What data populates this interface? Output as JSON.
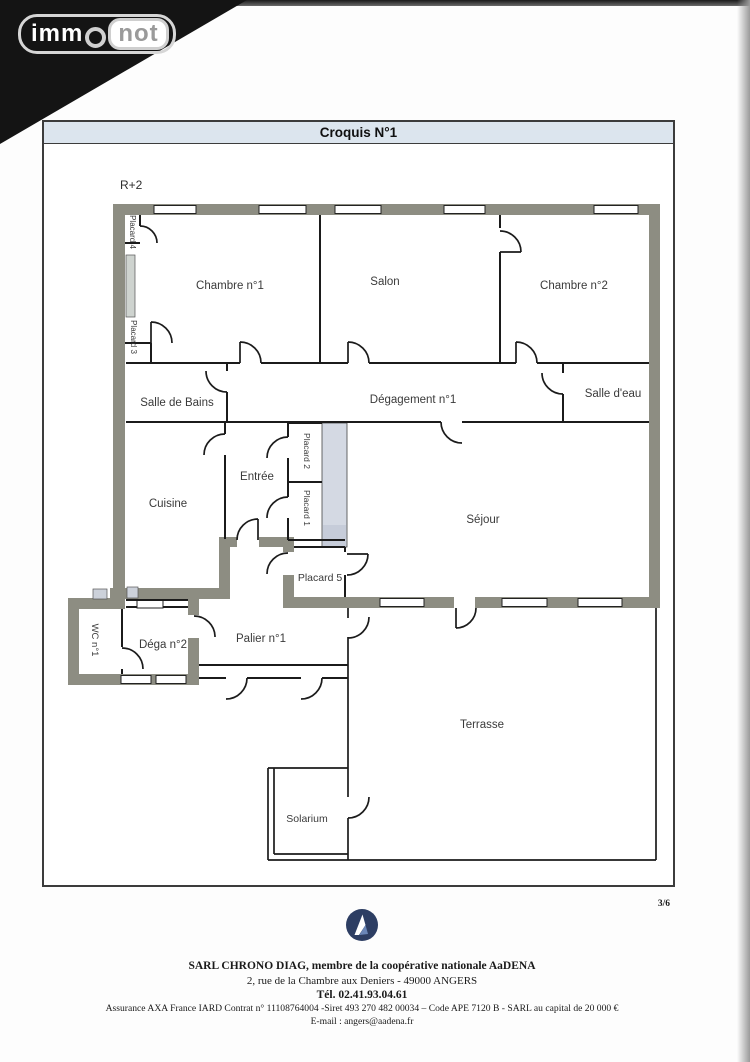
{
  "brand": {
    "part1": "imm",
    "circle_letter": "o",
    "part2": "not"
  },
  "croquis": {
    "title": "Croquis N°1",
    "level": "R+2"
  },
  "rooms": {
    "chambre1": "Chambre n°1",
    "salon": "Salon",
    "chambre2": "Chambre n°2",
    "salle_de_bains": "Salle de Bains",
    "degagement1": "Dégagement n°1",
    "salle_deau": "Salle d'eau",
    "cuisine": "Cuisine",
    "entree": "Entrée",
    "sejour": "Séjour",
    "placard5": "Placard 5",
    "palier1": "Palier n°1",
    "dega2": "Déga n°2",
    "terrasse": "Terrasse",
    "solarium": "Solarium",
    "placard4": "Placard 4",
    "placard3": "Placard 3",
    "placard2": "Placard 2",
    "placard1": "Placard 1",
    "wc1": "WC n°1"
  },
  "page_number": "3/6",
  "footer": {
    "company_line": "SARL CHRONO DIAG, membre de la coopérative nationale AaDENA",
    "address_line": "2, rue de la Chambre aux Deniers  - 49000  ANGERS",
    "phone_line": "Tél.  02.41.93.04.61",
    "legal_line": "Assurance AXA France IARD Contrat n° 11108764004 -Siret 493 270 482 00034  – Code APE 7120 B  - SARL au capital de 20 000 €",
    "email_line": "E-mail : angers@aadena.fr"
  },
  "colors": {
    "exterior_wall": "#8d8d82",
    "duct_shade": "#d4d9e3",
    "title_bar": "#dce5ee",
    "logo_navy": "#2d3e63"
  }
}
